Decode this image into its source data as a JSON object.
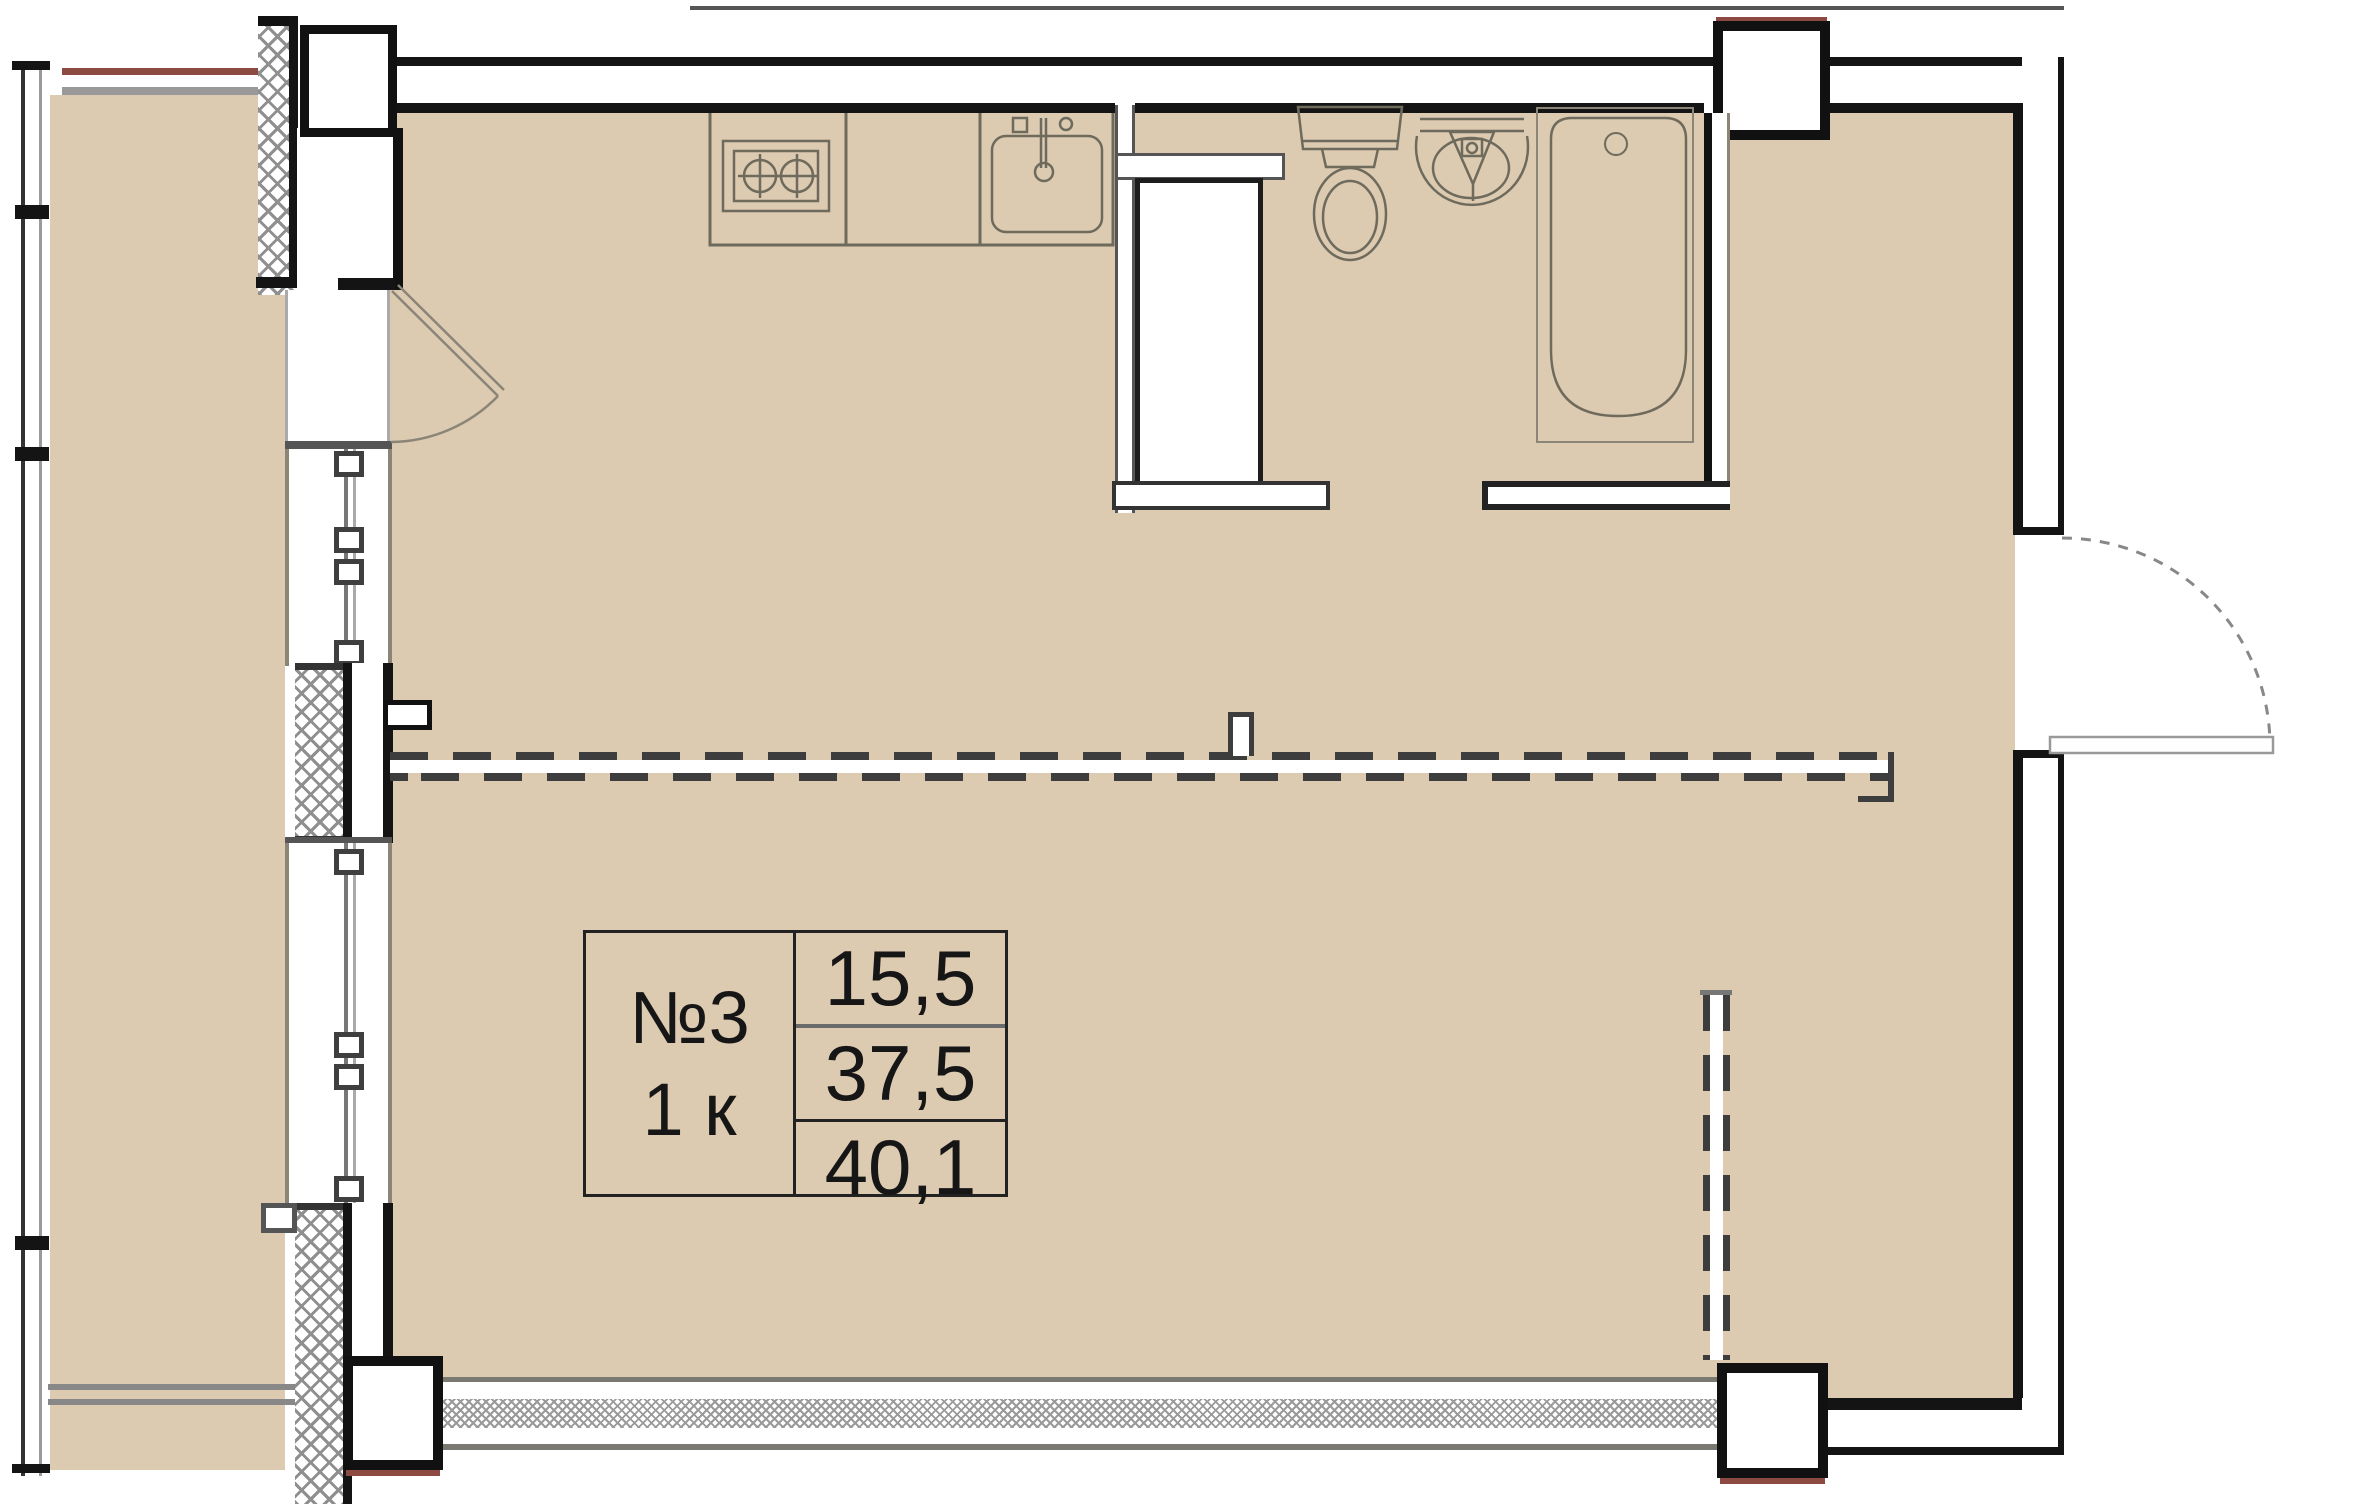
{
  "unit": {
    "number": "№3",
    "type": "1 к",
    "areas": {
      "living": "15,5",
      "apartment": "37,5",
      "total": "40,1"
    }
  },
  "colors": {
    "floor": "#dccab1",
    "wall": "#141414",
    "fixture_line": "#6e6a5c",
    "hatch": "#8f8f8f",
    "accent_red": "#8c4a42",
    "dashed_partition": "#3d3d3d"
  },
  "legend": {
    "fixtures": [
      "stove",
      "kitchen-sink",
      "ventilation-shaft",
      "toilet",
      "washbasin",
      "bathtub",
      "balcony-door",
      "entrance-door",
      "windows",
      "future-partitions"
    ]
  }
}
